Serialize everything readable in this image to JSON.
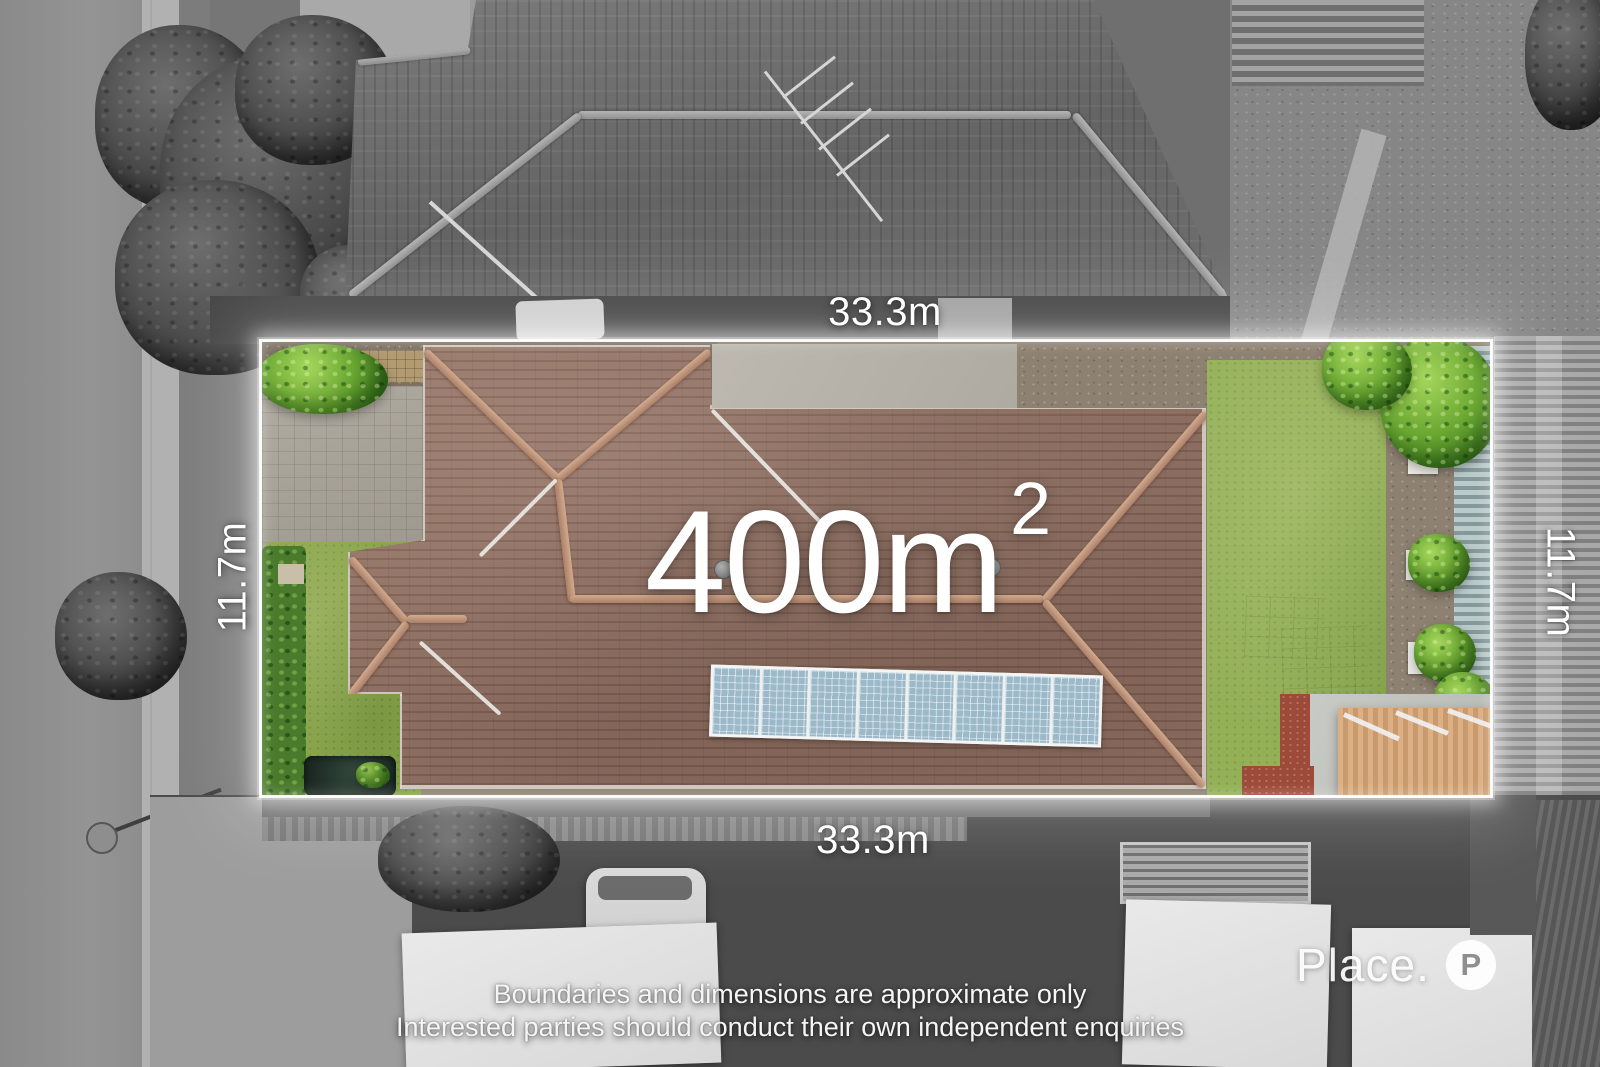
{
  "branding": {
    "logo_text": "Place.",
    "logo_icon_letter": "P"
  },
  "overlay": {
    "area_value": "400m",
    "area_exponent": "2",
    "dimensions": {
      "top": "33.3m",
      "bottom": "33.3m",
      "left": "11.7m",
      "right": "11.7m"
    },
    "disclaimer_line1": "Boundaries and dimensions are approximate only",
    "disclaimer_line2": "Interested parties should conduct their own independent enquiries"
  },
  "palette": {
    "boundary_line": "#ffffff",
    "label_text": "#ffffff",
    "roof_terracotta": "#8e7265",
    "lawn_green": "#94b057",
    "solar_panel_blue": "#9cb9ca",
    "timber_box": "#d9a97e",
    "mulch_red": "#9c4a39"
  }
}
